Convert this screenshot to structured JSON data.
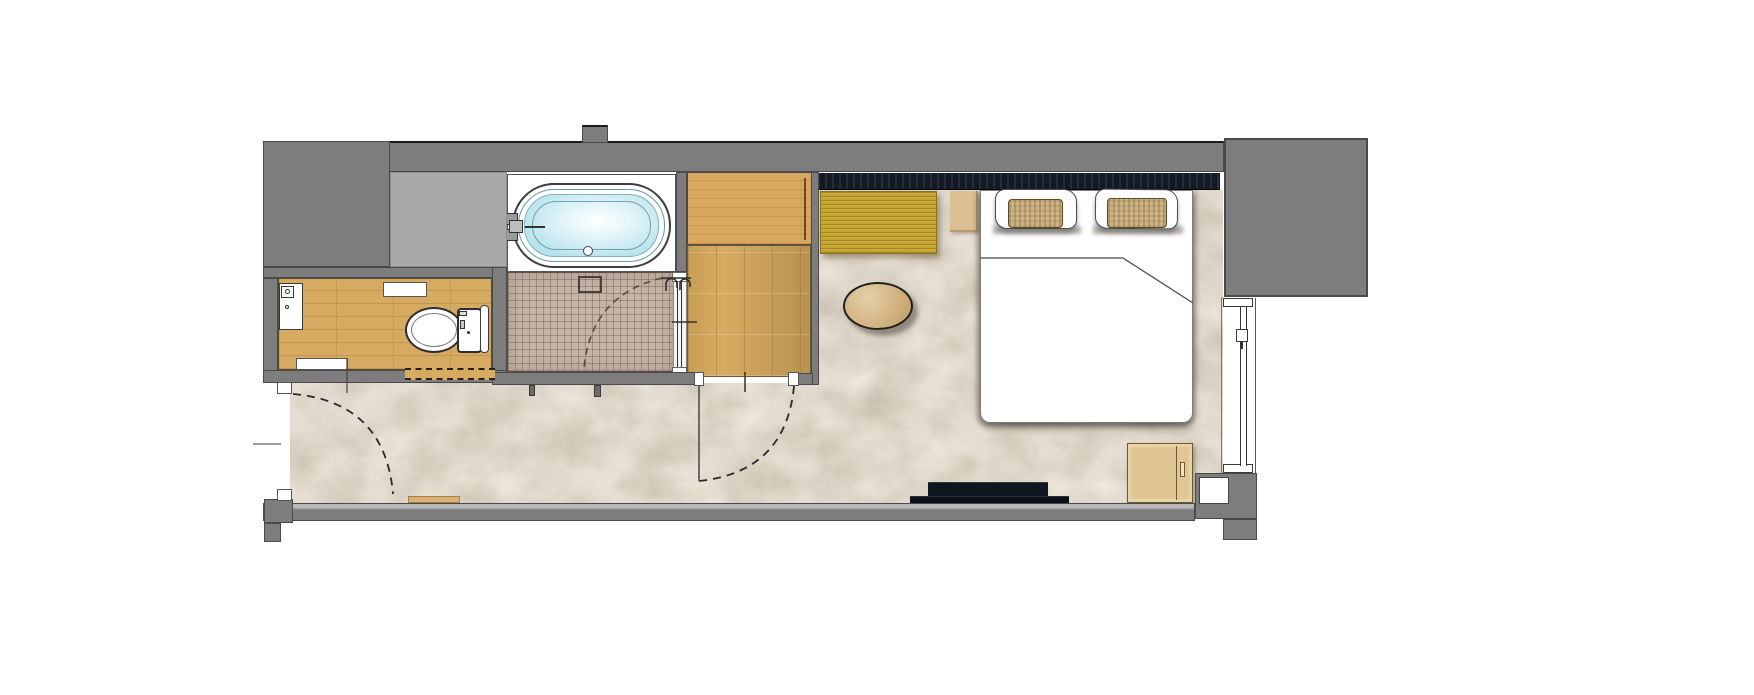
{
  "meta": {
    "type": "architectural-floor-plan",
    "subject": "hotel guestroom plan: entry hall, toilet room, bathtub room, tiled shower room, vanity dressing area, bedroom with window",
    "text_labels": []
  },
  "palette": {
    "wall": "#7d7d7d",
    "wall-light": "#a9a9a9",
    "wall-edge": "#4a4a4a",
    "carpet-dark": "#8c7a61",
    "carpet-light": "#eee0cc",
    "wood": "#d6ab61",
    "counter": "#d8a75f",
    "tile": "#c7b4a8",
    "water": "#a9dde9",
    "navy": "#141a24",
    "bench": "#c4a42e",
    "table": "#d3b382",
    "cabinet": "#e0c792",
    "media": "#10161f",
    "weave": "#cdb489"
  },
  "rooms": [
    {
      "id": "entry-hall",
      "floor": "carpet"
    },
    {
      "id": "toilet-room",
      "floor": "wood"
    },
    {
      "id": "bathtub-room",
      "floor": "sheet"
    },
    {
      "id": "shower-room",
      "floor": "tile"
    },
    {
      "id": "dressing-area",
      "floor": "wood"
    },
    {
      "id": "bedroom",
      "floor": "carpet"
    }
  ],
  "fixtures": [
    "bathtub",
    "bathtub-faucet",
    "bathtub-drain",
    "floor-drain",
    "shower-mixer",
    "glass-shower-door",
    "vanity-sink",
    "sink-faucet",
    "toilet",
    "hand-basin",
    "wall-shelf",
    "sliding-door",
    "entry-door-swing",
    "dressing-door-swing",
    "shower-door-swing",
    "headboard-panel",
    "bench-seat",
    "side-table",
    "double-bed",
    "pillows",
    "duvet-fold",
    "oval-table",
    "tv-board",
    "nightstand",
    "window",
    "window-handle"
  ]
}
